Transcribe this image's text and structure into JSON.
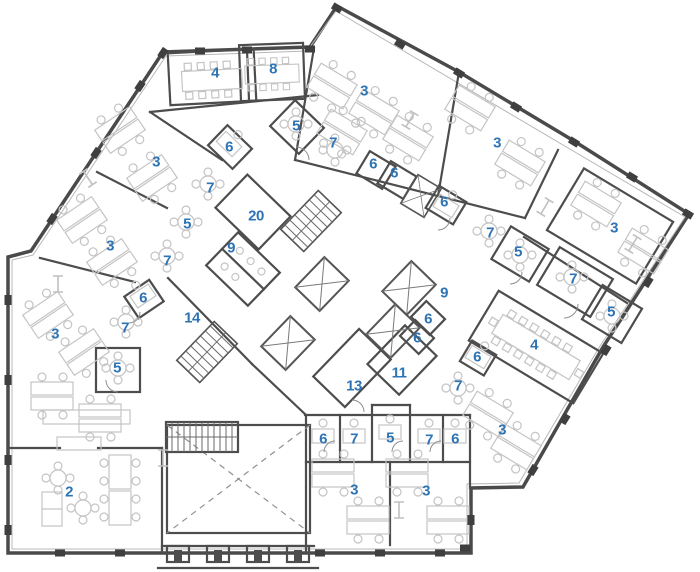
{
  "image_type": "architectural-floor-plan",
  "colors": {
    "label": "#2e74b5",
    "wall": "#4d4d4d",
    "furniture": "#c4c4c4",
    "background": "#ffffff"
  },
  "rooms": [
    {
      "label": "4",
      "x": 215,
      "y": 73
    },
    {
      "label": "8",
      "x": 273,
      "y": 69
    },
    {
      "label": "3",
      "x": 364,
      "y": 91
    },
    {
      "label": "5",
      "x": 296,
      "y": 126
    },
    {
      "label": "7",
      "x": 333,
      "y": 143
    },
    {
      "label": "6",
      "x": 229,
      "y": 147
    },
    {
      "label": "3",
      "x": 156,
      "y": 162
    },
    {
      "label": "3",
      "x": 497,
      "y": 143
    },
    {
      "label": "6",
      "x": 373,
      "y": 164
    },
    {
      "label": "6",
      "x": 394,
      "y": 173
    },
    {
      "label": "7",
      "x": 210,
      "y": 188
    },
    {
      "label": "6",
      "x": 444,
      "y": 202
    },
    {
      "label": "20",
      "x": 256,
      "y": 216
    },
    {
      "label": "5",
      "x": 187,
      "y": 224
    },
    {
      "label": "3",
      "x": 614,
      "y": 228
    },
    {
      "label": "7",
      "x": 490,
      "y": 233
    },
    {
      "label": "3",
      "x": 110,
      "y": 246
    },
    {
      "label": "9",
      "x": 231,
      "y": 248
    },
    {
      "label": "5",
      "x": 518,
      "y": 252
    },
    {
      "label": "7",
      "x": 167,
      "y": 261
    },
    {
      "label": "7",
      "x": 573,
      "y": 279
    },
    {
      "label": "9",
      "x": 444,
      "y": 293
    },
    {
      "label": "6",
      "x": 143,
      "y": 298
    },
    {
      "label": "5",
      "x": 611,
      "y": 312
    },
    {
      "label": "14",
      "x": 192,
      "y": 318
    },
    {
      "label": "6",
      "x": 428,
      "y": 319
    },
    {
      "label": "7",
      "x": 125,
      "y": 328
    },
    {
      "label": "3",
      "x": 55,
      "y": 334
    },
    {
      "label": "6",
      "x": 417,
      "y": 338
    },
    {
      "label": "4",
      "x": 534,
      "y": 345
    },
    {
      "label": "6",
      "x": 477,
      "y": 357
    },
    {
      "label": "5",
      "x": 117,
      "y": 368
    },
    {
      "label": "11",
      "x": 399,
      "y": 373
    },
    {
      "label": "13",
      "x": 354,
      "y": 386
    },
    {
      "label": "7",
      "x": 458,
      "y": 386
    },
    {
      "label": "7",
      "x": 429,
      "y": 440
    },
    {
      "label": "3",
      "x": 502,
      "y": 430
    },
    {
      "label": "5",
      "x": 390,
      "y": 438
    },
    {
      "label": "6",
      "x": 323,
      "y": 439
    },
    {
      "label": "7",
      "x": 354,
      "y": 439
    },
    {
      "label": "6",
      "x": 455,
      "y": 439
    },
    {
      "label": "2",
      "x": 69,
      "y": 492
    },
    {
      "label": "3",
      "x": 354,
      "y": 490
    },
    {
      "label": "3",
      "x": 426,
      "y": 491
    }
  ]
}
